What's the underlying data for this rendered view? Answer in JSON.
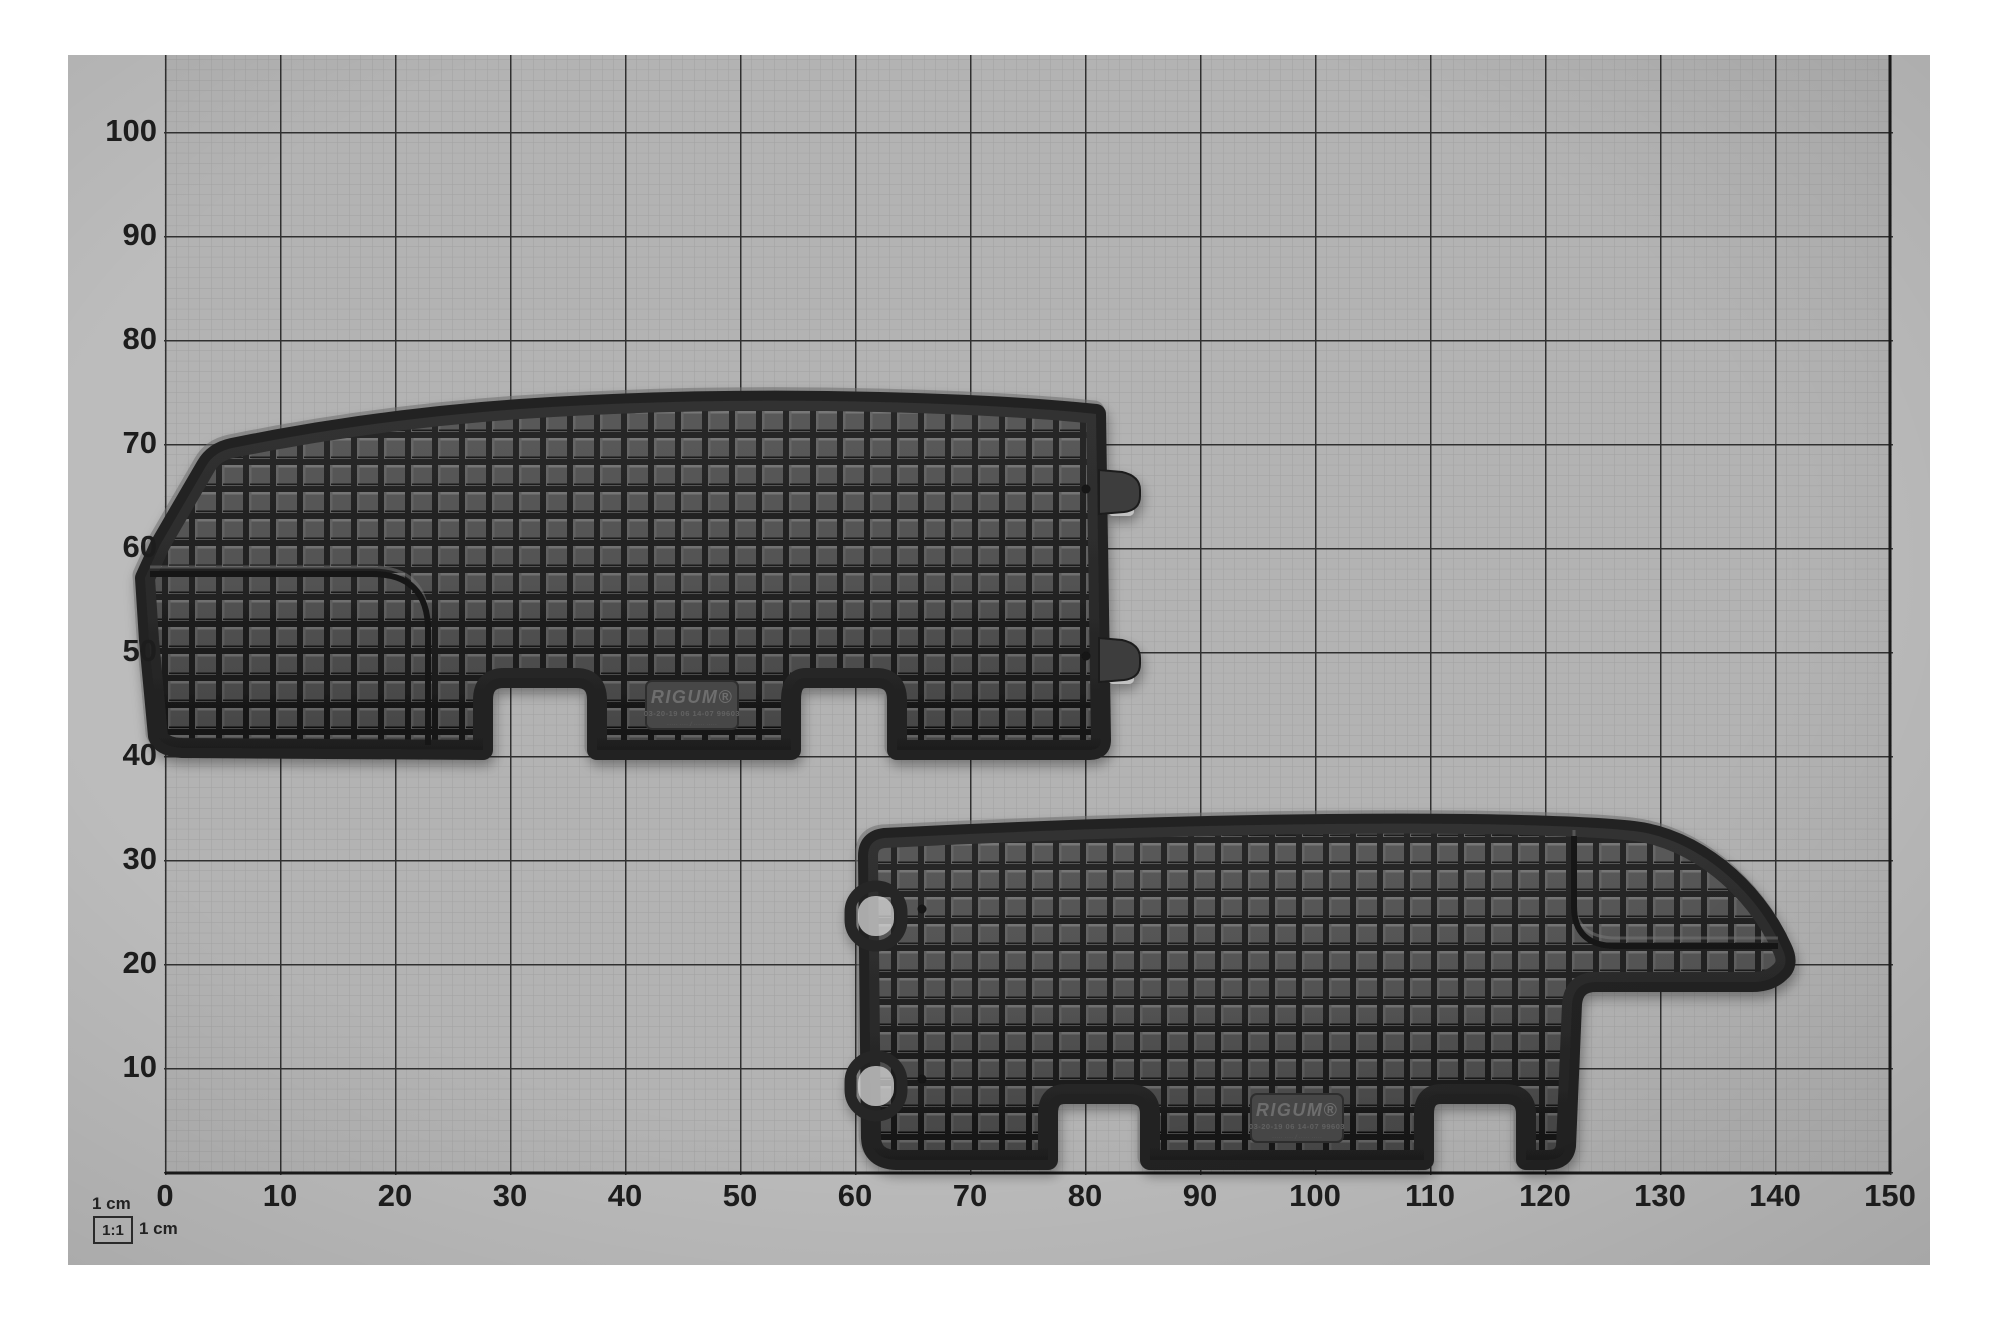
{
  "colors": {
    "paper": "#b5b5b5",
    "paper_margin": "#bcbcbc",
    "grid_fine_line": "#969696",
    "grid_major_line": "#1b1b1b",
    "mat_surface": "#4e4e4e",
    "mat_groove": "#181818",
    "page_background": "#ffffff"
  },
  "axes": {
    "x": {
      "ticks": [
        0,
        10,
        20,
        30,
        40,
        50,
        60,
        70,
        80,
        90,
        100,
        110,
        120,
        130,
        140,
        150
      ]
    },
    "y": {
      "ticks": [
        10,
        20,
        30,
        40,
        50,
        60,
        70,
        80,
        90,
        100
      ]
    }
  },
  "scale": {
    "label_top": "1 cm",
    "ratio": "1:1",
    "label_right": "1 cm"
  },
  "mats": [
    {
      "brand": "RIGUM®",
      "code_line": "03-20-19  06  14-07  99603",
      "note_line": "····· ····  /  ····· ·····"
    },
    {
      "brand": "RIGUM®",
      "code_line": "03-20-19  06  14-07  99603",
      "note_line": "····· ····  /  ····· ·····"
    }
  ]
}
